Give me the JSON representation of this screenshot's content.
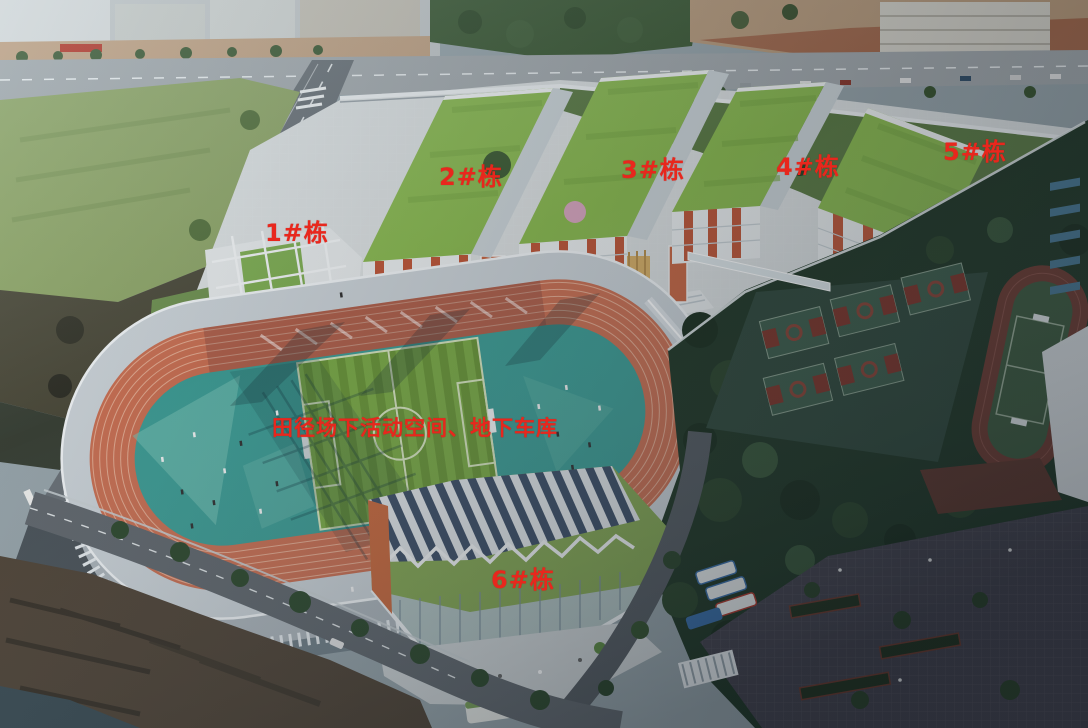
{
  "annotations": {
    "label_color": "#e8271d",
    "building_labels": [
      {
        "id": "1",
        "text": "1#栋"
      },
      {
        "id": "2",
        "text": "2#栋"
      },
      {
        "id": "3",
        "text": "3#栋"
      },
      {
        "id": "4",
        "text": "4#栋"
      },
      {
        "id": "5",
        "text": "5#栋"
      },
      {
        "id": "6",
        "text": "6#栋"
      }
    ],
    "area_label": {
      "text": "田径场下活动空间、地下车库"
    }
  },
  "palette": {
    "label_red": "#e8271d",
    "green_roof": "#8cbb52",
    "facade_white": "#e9ecee",
    "accent_orange": "#c0583a",
    "track_orange": "#cb7154",
    "infield_teal": "#3f9e96",
    "pitch_green_light": "#7cab47",
    "pitch_green_dark": "#6b9639",
    "court_surface": "#31493c",
    "court_key_red": "#7e352a",
    "dark_trees": "#223827",
    "road_gray": "#969ca1",
    "plaza_light": "#dde1e2",
    "construction_tan": "#b99b7c",
    "cliff_brown": "#514538",
    "water_dark": "#3c4d55"
  }
}
